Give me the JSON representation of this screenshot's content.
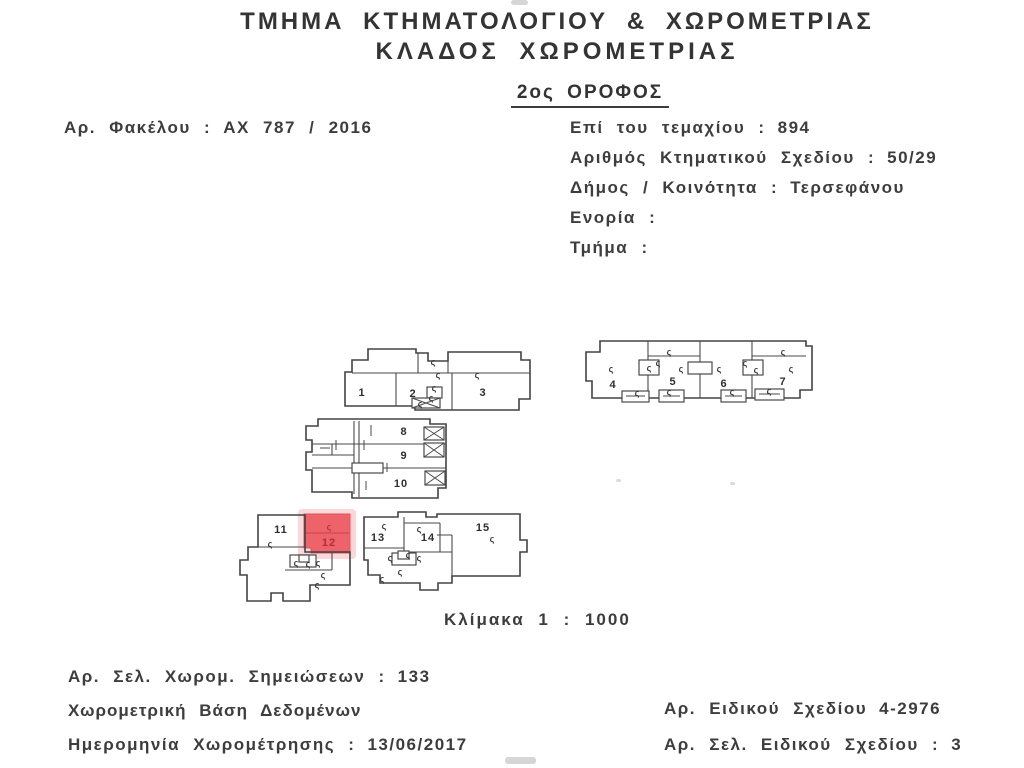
{
  "header": {
    "department_line1": "ΤΜΗΜΑ  ΚΤΗΜΑΤΟΛΟΓΙΟΥ  &  ΧΩΡΟΜΕΤΡΙΑΣ",
    "department_line2": "ΚΛΑΔΟΣ  ΧΩΡΟΜΕΤΡΙΑΣ",
    "floor": "2ος ΟΡΟΦΟΣ"
  },
  "info_left": {
    "file_row": {
      "label": "Αρ.  Φακέλου  :",
      "value": "ΑΧ 787 / 2016"
    }
  },
  "info_right": {
    "rows": [
      {
        "label": "Επί  του  τεμαχίου  :",
        "value": "894"
      },
      {
        "label": "Αριθμός  Κτηματικού  Σχεδίου  :",
        "value": "50/29"
      },
      {
        "label": "Δήμος / Κοινότητα  :",
        "value": "Τερσεφάνου"
      },
      {
        "label": "Ενορία  :",
        "value": ""
      },
      {
        "label": "Τμήμα  :",
        "value": ""
      }
    ]
  },
  "plan": {
    "scale_label": "Κλίμακα  1 : 1000",
    "mark": "ς",
    "units": [
      "1",
      "2",
      "3",
      "4",
      "5",
      "6",
      "7",
      "8",
      "9",
      "10",
      "11",
      "12",
      "13",
      "14",
      "15"
    ],
    "highlighted_unit": "12",
    "highlight_color": "#ee5a61",
    "line_color": "#434343"
  },
  "footer_left": {
    "rows": [
      {
        "label": "Αρ.  Σελ.  Χωρομ.  Σημειώσεων  :",
        "value": "133"
      },
      {
        "label": "Χωρομετρική Βάση Δεδομένων",
        "value": ""
      },
      {
        "label": "Ημερομηνία  Χωρομέτρησης  :",
        "value": "13/06/2017"
      }
    ]
  },
  "footer_right": {
    "rows": [
      {
        "label": "Αρ.  Ειδικού  Σχεδίου",
        "value": "4-2976"
      },
      {
        "label": "Αρ.  Σελ.  Ειδικού  Σχεδίου  :",
        "value": "3"
      }
    ]
  }
}
